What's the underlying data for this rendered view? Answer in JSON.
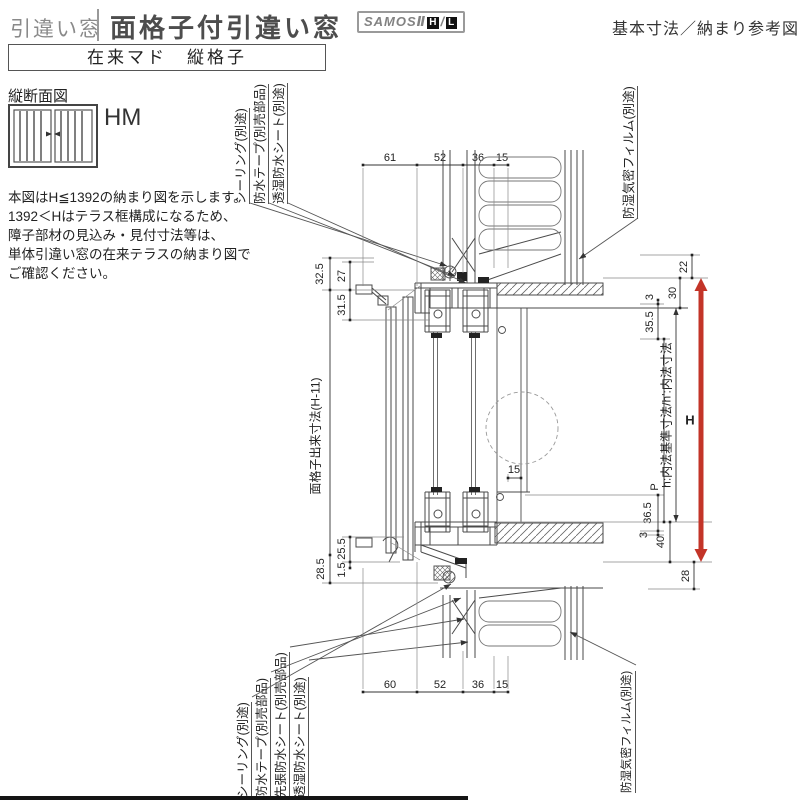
{
  "header": {
    "category": "引違い窓",
    "title": "面格子付引違い窓",
    "brand": "SAMOSⅡ",
    "brand_h": "H",
    "brand_slash": "/",
    "brand_l": "L",
    "right_note": "基本寸法／納まり参考図",
    "subtitle": "在来マド　縦格子"
  },
  "sidebar": {
    "section_label": "縦断面図",
    "series_label": "HM",
    "note_lines": [
      "本図はH≦1392の納まり図を示します。",
      "1392＜Hはテラス框構成になるため、",
      "障子部材の見込み・見付寸法等は、",
      "単体引違い窓の在来テラスの納まり図で",
      "ご確認ください。"
    ]
  },
  "callouts": {
    "top": [
      "シーリング(別途)",
      "防水テープ(別売部品)",
      "透湿防水シート(別途)"
    ],
    "top_right": "防湿気密フィルム(別途)",
    "bottom": [
      "シーリング(別途)",
      "防水テープ(別売部品)",
      "先張防水シート(別売部品)",
      "透湿防水シート(別途)"
    ],
    "bottom_right": "防湿気密フィルム(別途)"
  },
  "dims": {
    "top": [
      "61",
      "52",
      "36",
      "15"
    ],
    "bottom": [
      "60",
      "52",
      "36",
      "15"
    ],
    "mid_15": "15",
    "left_32_5": "32.5",
    "left_27": "27",
    "left_31_5": "31.5",
    "left_grille": "面格子出来寸法(H-11)",
    "left_25_5": "25.5",
    "left_1_5": "1.5",
    "left_28_5": "28.5",
    "right_22": "22",
    "right_30": "30",
    "right_3a": "3",
    "right_35_5": "35.5",
    "right_p": "P",
    "right_inner": "h:内法基準寸法/h':内法寸法",
    "right_36_5": "36.5",
    "right_3b": "3",
    "right_40": "40",
    "right_28": "28",
    "height_h": "H"
  },
  "colors": {
    "accent_red": "#c33428"
  }
}
